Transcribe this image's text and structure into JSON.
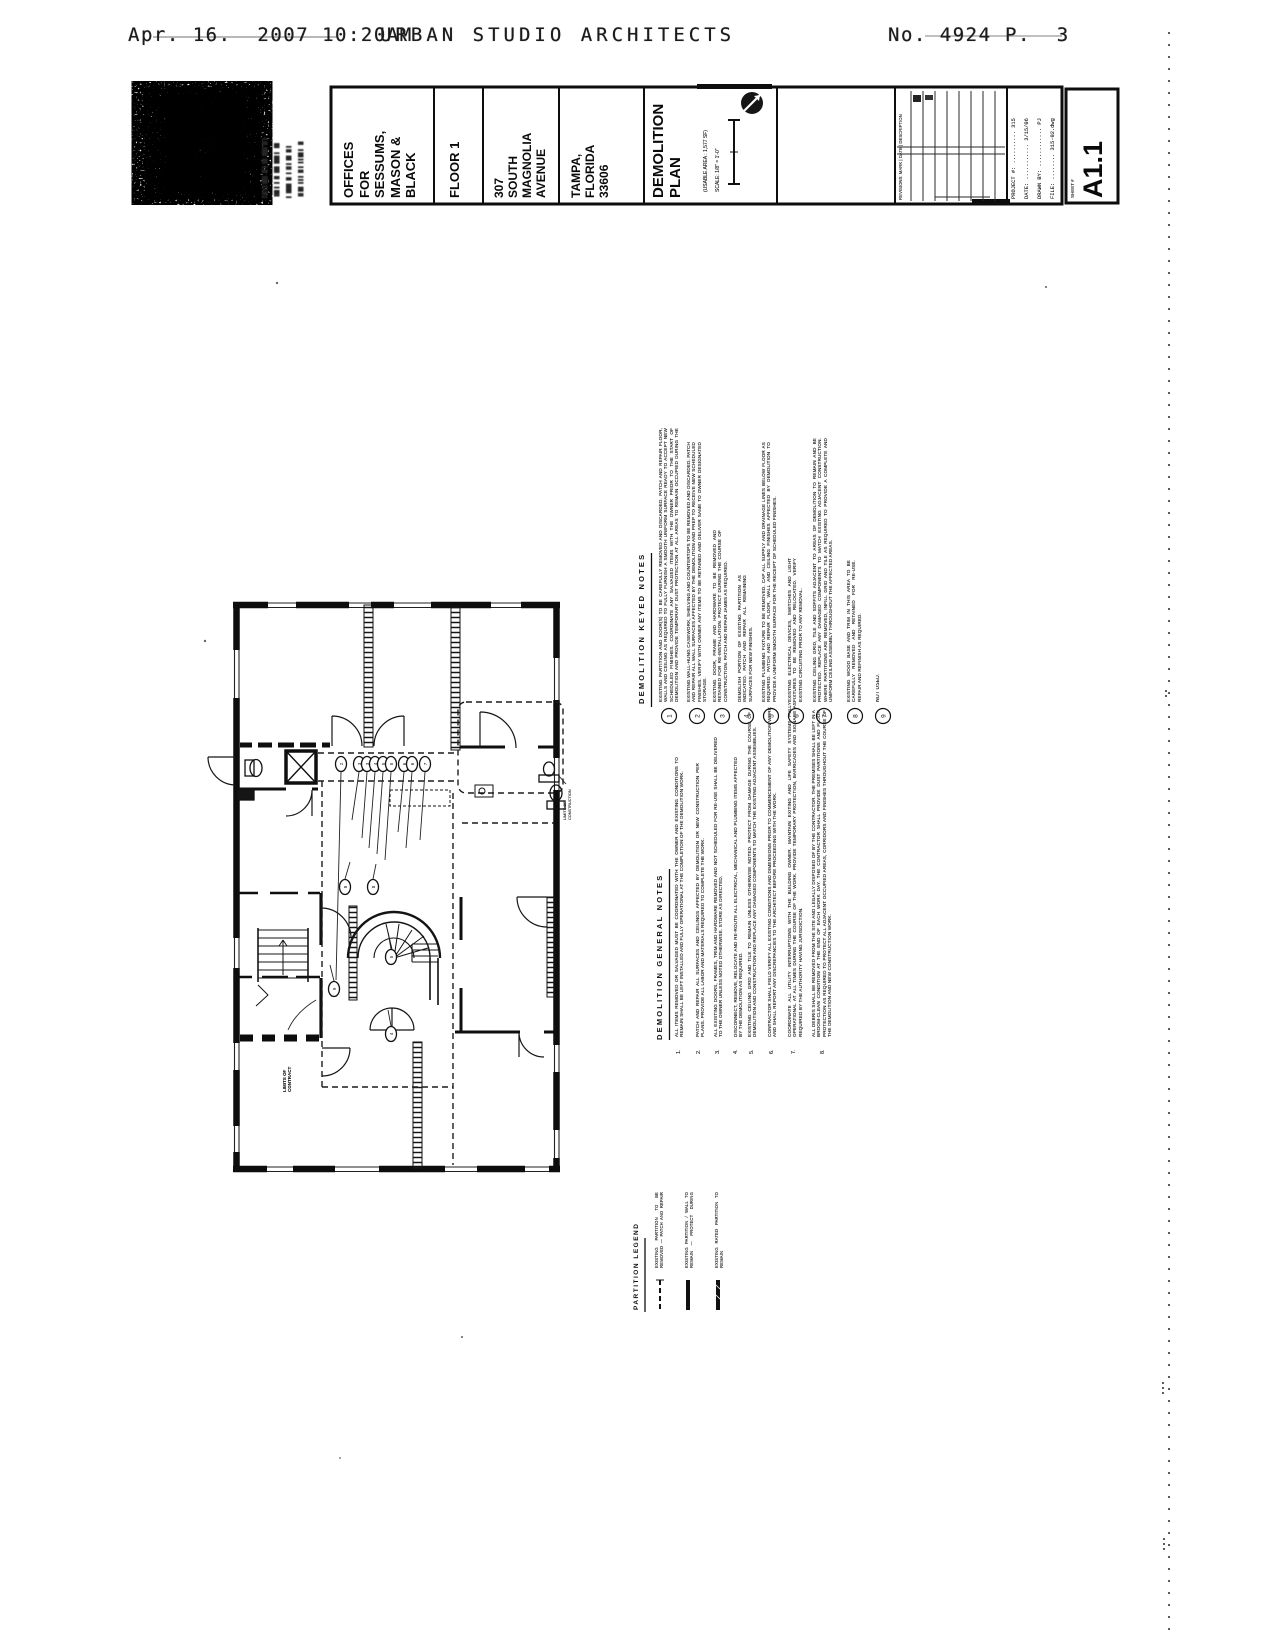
{
  "fax_header": {
    "datetime": "Apr. 16.  2007 10:20AM",
    "sender": "URBAN STUDIO ARCHITECTS",
    "doc_number": "No. 4924",
    "page_number": "P.  3"
  },
  "logo": {
    "firm_name": "URBAN",
    "contact_lines": [
      "▌█▐ ▌██▌▐▌▌ █▌▐██ ▐▌▌",
      "▐█▌▌▐ ▐▌▐█▌ ██▌▌ ▐█",
      "▌▐██▌▐▌▐ ▐▌▌ █▌▐▌▌",
      "▐▌█▌▐ ▌▌▐▌▌▐ ▌█▌▌ ▐▌"
    ]
  },
  "title_block": {
    "client": "OFFICES\nFOR\nSESSUMS,\nMASON &\nBLACK",
    "floor": "FLOOR 1",
    "address": "307\nSOUTH\nMAGNOLIA\nAVENUE",
    "city": "TAMPA,\nFLORIDA\n33606",
    "sheet_title": "DEMOLITION\nPLAN",
    "usable_area": "(USABLE AREA : 1,577 SF)",
    "scale_label": "SCALE: 1/8\" = 1'-0\"",
    "revisions_label": "REVISIONS:   MARK | DATE | DESCRIPTION",
    "fields": [
      "PROJECT #: .......... 315",
      "DATE: ........... 3/15/06",
      "DRAWN BY: ............ PJ",
      "FILE: ........ 315-02.dwg"
    ],
    "sheet_label": "SHEET #",
    "sheet_number": "A1.1"
  },
  "plan": {
    "limit_label_bottom": "LIMITS OF\nCONTRACT",
    "limit_label_right": "LIMITS OF\nCONSTRUCTION",
    "tags": [
      "2",
      "3",
      "3",
      "4",
      "5",
      "5",
      "6",
      "6",
      "7",
      "8",
      "8",
      "9",
      "5",
      "4"
    ]
  },
  "notes": {
    "keyed": {
      "title": "DEMOLITION  KEYED  NOTES",
      "items": [
        {
          "num": "1",
          "text": "EXISTING PARTITION AND DOOR(S) TO BE CAREFULLY REMOVED AND DISCARDED. PATCH AND REPAIR FLOOR, WALLS AND CEILING AS REQUIRED TO FULLY FURNISH A SMOOTH UNIFORM SURFACE READY TO ACCEPT NEW SCHEDULED FINISHES. COORDINATE ANY SALVAGED ITEMS WITH THE OWNER PRIOR TO THE START OF DEMOLITION AND PROVIDE TEMPORARY DUST PROTECTION AT ALL AREAS TO REMAIN OCCUPIED DURING THE COURSE OF THE WORK."
        },
        {
          "num": "2",
          "text": "EXISTING WALL-HUNG CASEWORK, SHELVING AND COUNTERTOPS TO BE REMOVED AND DISCARDED. PATCH AND REPAIR ALL WALL SURFACES AFFECTED BY THE DEMOLITION AND PREP TO RECEIVE NEW SCHEDULED FINISHES. VERIFY WITH OWNER ANY ITEMS TO BE RETAINED AND DELIVER SAME TO OWNER DESIGNATED STORAGE."
        },
        {
          "num": "3",
          "text": "EXISTING DOOR, FRAME AND HARDWARE TO BE REMOVED AND RETAINED FOR RE-INSTALLATION. PROTECT DURING THE COURSE OF CONSTRUCTION. PATCH AND REPAIR JAMBS AS REQUIRED."
        },
        {
          "num": "4",
          "text": "DEMOLISH PORTION OF EXISTING PARTITION AS INDICATED. PATCH AND REPAIR ALL REMAINING SURFACES FOR NEW FINISHES."
        },
        {
          "num": "5",
          "text": "EXISTING PLUMBING FIXTURE TO BE REMOVED. CAP ALL SUPPLY AND DRAINAGE LINES BELOW FLOOR AS REQUIRED. PATCH AND REPAIR FLOOR, WALL AND CEILING FINISHES AFFECTED BY DEMOLITION TO PROVIDE A UNIFORM SMOOTH SURFACE FOR THE RECEIPT OF SCHEDULED FINISHES."
        },
        {
          "num": "6",
          "text": "EXISTING ELECTRICAL DEVICES, SWITCHES AND LIGHT FIXTURES TO BE REMOVED AND RELOCATED. VERIFY EXISTING CIRCUITING PRIOR TO ANY REMOVAL."
        },
        {
          "num": "7",
          "text": "EXISTING CEILING GRID, TILE AND SOFFITS ADJACENT TO AREAS OF DEMOLITION TO REMAIN AND BE PROTECTED. REPLACE ANY DAMAGED COMPONENTS TO MATCH EXISTING ADJACENT CONSTRUCTION. WHERE PARTITIONS ARE REMOVED, INFILL GRID AND TILE AS REQUIRED TO PROVIDE A COMPLETE AND UNIFORM CEILING ASSEMBLY THROUGHOUT THE AFFECTED AREAS."
        },
        {
          "num": "8",
          "text": "EXISTING WOOD BASE AND TRIM IN THIS AREA TO BE CAREFULLY REMOVED AND RETAINED FOR RE-USE. REPAIR AND REFINISH AS REQUIRED."
        },
        {
          "num": "9",
          "text": "NOT USED."
        }
      ]
    },
    "general": {
      "title": "DEMOLITION  GENERAL  NOTES",
      "items": [
        {
          "num": "1.",
          "text": "ALL ITEMS REMOVED OR SALVAGED MUST BE COORDINATED WITH THE OWNER AND EXISTING CONDITIONS TO REMAIN SHALL BE LEFT INSTALLED AND FULLY OPERATIONAL AT THE COMPLETION OF THE DEMOLITION WORK."
        },
        {
          "num": "2.",
          "text": "PATCH AND REPAIR ALL SURFACES AND CEILINGS AFFECTED BY DEMOLITION OR NEW CONSTRUCTION PER PLANS. PROVIDE ALL LABOR AND MATERIALS REQUIRED TO COMPLETE THE WORK."
        },
        {
          "num": "3.",
          "text": "ALL EXISTING DOORS, FRAMES, TRIM AND HARDWARE REMOVED AND NOT SCHEDULED FOR RE-USE SHALL BE DELIVERED TO THE OWNER UNLESS NOTED OTHERWISE. STORE AS DIRECTED."
        },
        {
          "num": "4.",
          "text": "DISCONNECT, REMOVE, RELOCATE AND RE-ROUTE ALL ELECTRICAL, MECHANICAL AND PLUMBING ITEMS AFFECTED BY THE DEMOLITION AS REQUIRED."
        },
        {
          "num": "5.",
          "text": "EXISTING CEILING GRID AND TILE TO REMAIN UNLESS OTHERWISE NOTED. PROTECT FROM DAMAGE DURING THE COURSE OF DEMOLITION AND CONSTRUCTION AND REPLACE ANY DAMAGED COMPONENTS TO MATCH THE EXISTING ADJACENT ASSEMBLIES."
        },
        {
          "num": "6.",
          "text": "CONTRACTOR SHALL FIELD VERIFY ALL EXISTING CONDITIONS AND DIMENSIONS PRIOR TO COMMENCEMENT OF ANY DEMOLITION WORK AND SHALL REPORT ANY DISCREPANCIES TO THE ARCHITECT BEFORE PROCEEDING WITH THE WORK."
        },
        {
          "num": "7.",
          "text": "COORDINATE ALL UTILITY INTERRUPTIONS WITH THE BUILDING OWNER. MAINTAIN EXITING AND LIFE SAFETY SYSTEMS FULLY OPERATIONAL AT ALL TIMES DURING THE COURSE OF THE WORK. PROVIDE TEMPORARY PROTECTION, BARRICADES AND SIGNAGE AS REQUIRED BY THE AUTHORITY HAVING JURISDICTION."
        },
        {
          "num": "8.",
          "text": "ALL DEBRIS SHALL BE REMOVED FROM THE SITE AND LEGALLY DISPOSED OF BY THE CONTRACTOR. THE PREMISES SHALL BE LEFT IN A BROOM-CLEAN CONDITION AT THE END OF EACH WORK DAY. THE CONTRACTOR SHALL PROVIDE DUST PARTITIONS AND FLOOR PROTECTION AS REQUIRED TO PROTECT ALL ADJACENT OCCUPIED AREAS, CORRIDORS AND FINISHES THROUGHOUT THE COURSE OF THE DEMOLITION AND NEW CONSTRUCTION WORK."
        }
      ]
    },
    "legend": {
      "title": "PARTITION  LEGEND",
      "items": [
        {
          "label": "EXISTING PARTITION TO BE REMOVED — PATCH AND REPAIR ADJACENT SURFACES TO REMAIN"
        },
        {
          "label": "EXISTING PARTITION / WALL TO REMAIN — PROTECT DURING DEMOLITION"
        },
        {
          "label": "EXISTING RATED PARTITION TO REMAIN"
        }
      ]
    }
  }
}
